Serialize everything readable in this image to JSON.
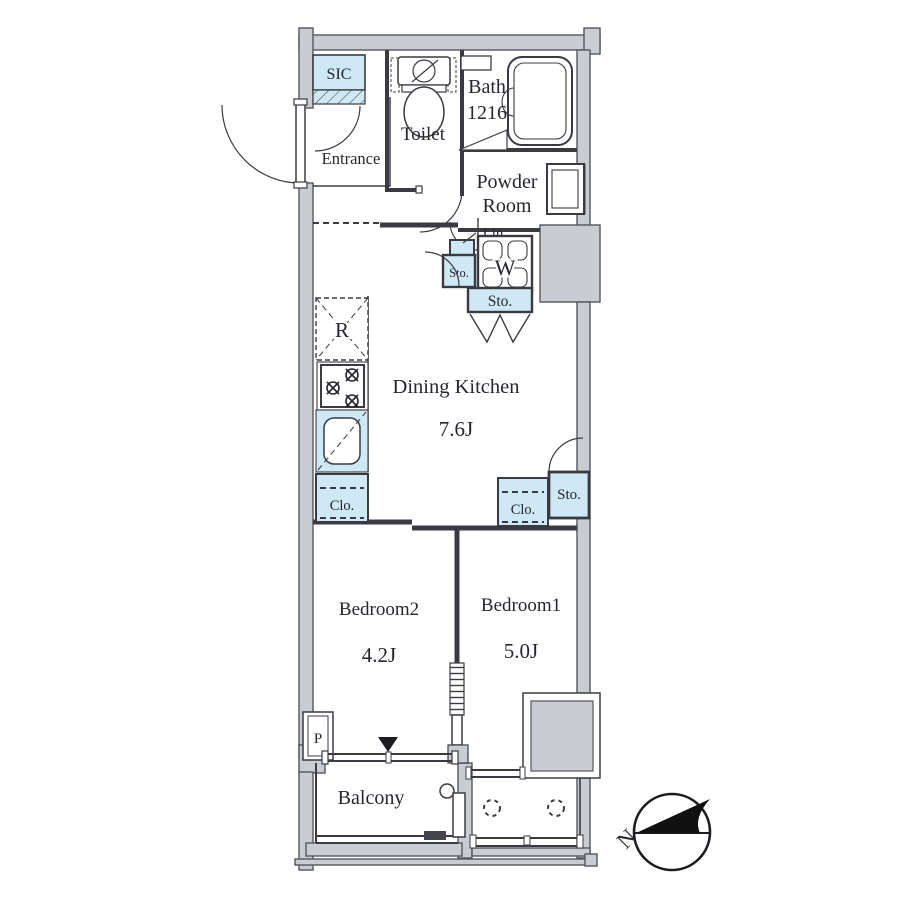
{
  "title": "Apartment floor plan 1DK with balcony",
  "colors": {
    "wall": "#c9cdd3",
    "closet_blue": "#cfe8f5",
    "line": "#3a3b42",
    "text": "#26262e",
    "background": "#ffffff"
  },
  "labels": {
    "sic": "SIC",
    "entrance": "Entrance",
    "toilet": "Toilet",
    "bath_line1": "Bath",
    "bath_line2": "1216",
    "powder_line1": "Powder",
    "powder_line2": "Room",
    "hall": "Hall",
    "lin": "Lin",
    "washer": "W",
    "sto_small": "Sto.",
    "sto_folding": "Sto.",
    "sto_right": "Sto.",
    "fridge": "R",
    "dk_name": "Dining Kitchen",
    "dk_size": "7.6J",
    "clo_left": "Clo.",
    "clo_right": "Clo.",
    "bedroom2_name": "Bedroom2",
    "bedroom2_size": "4.2J",
    "bedroom1_name": "Bedroom1",
    "bedroom1_size": "5.0J",
    "pipe_space": "P",
    "balcony": "Balcony",
    "compass_north": "N"
  }
}
